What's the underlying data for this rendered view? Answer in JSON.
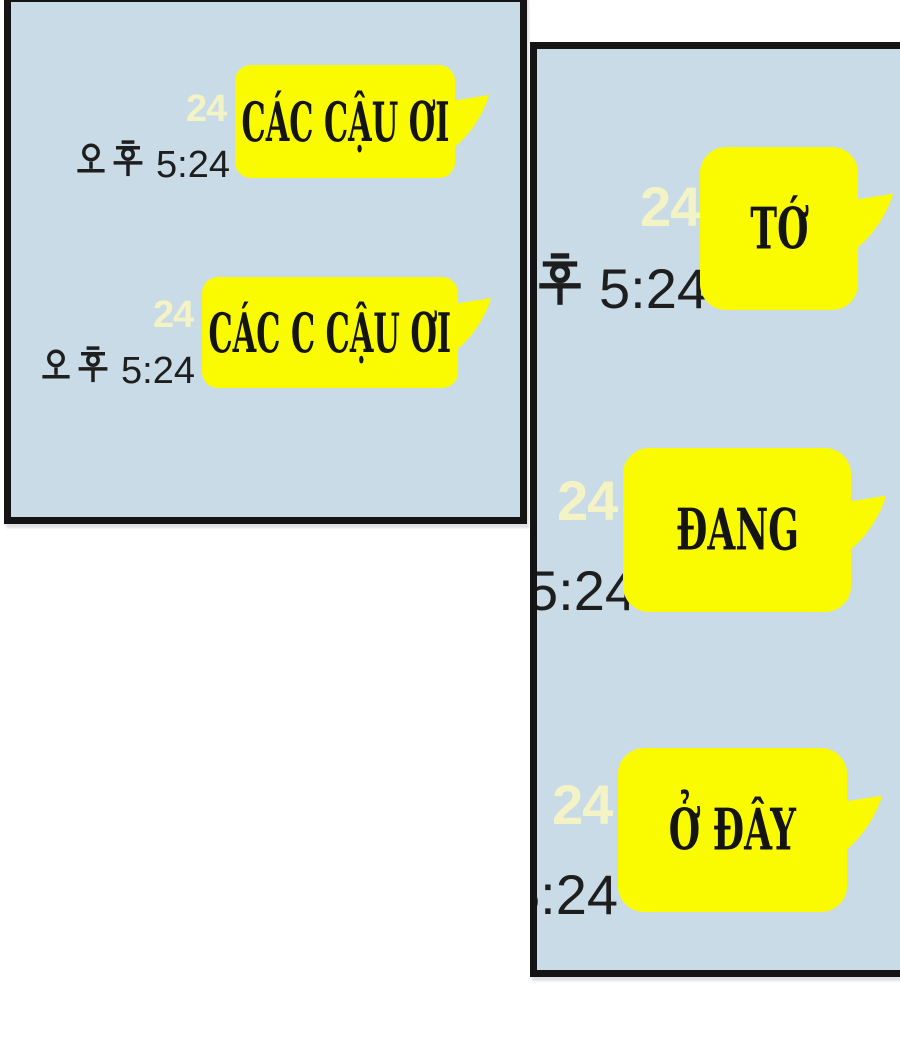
{
  "meta": {
    "kind": "webtoon-chat-panels",
    "colors": {
      "page_background": "#ffffff",
      "panel_background": "#c9dbe7",
      "panel_border": "#141414",
      "bubble_yellow": "#fbfb00",
      "faded_badge": "#f3f3c6",
      "timestamp_text": "#1e1e1e",
      "bubble_text": "#141414"
    }
  },
  "panels": [
    {
      "id": "left",
      "messages": [
        {
          "bubble_text": "CÁC CẬU ƠI",
          "badge": "24",
          "timestamp": "오후 5:24",
          "timestamp_prefix": "오후",
          "time": "5:24"
        },
        {
          "bubble_text": "CÁC C CẬU ƠI",
          "badge": "24",
          "timestamp": "오후 5:24",
          "timestamp_prefix": "오후",
          "time": "5:24"
        }
      ]
    },
    {
      "id": "right",
      "messages": [
        {
          "bubble_text": "TỚ",
          "badge": "24",
          "timestamp": "오후 5:24",
          "timestamp_prefix": "오후",
          "time": "5:24"
        },
        {
          "bubble_text": "ĐANG",
          "badge": "24",
          "timestamp": "오후 5:24",
          "timestamp_prefix": "오후",
          "time": "5:24"
        },
        {
          "bubble_text": "Ở ĐÂY",
          "badge": "24",
          "timestamp": "오후 5:24",
          "timestamp_prefix": "오후",
          "time": "5:24"
        }
      ]
    }
  ]
}
